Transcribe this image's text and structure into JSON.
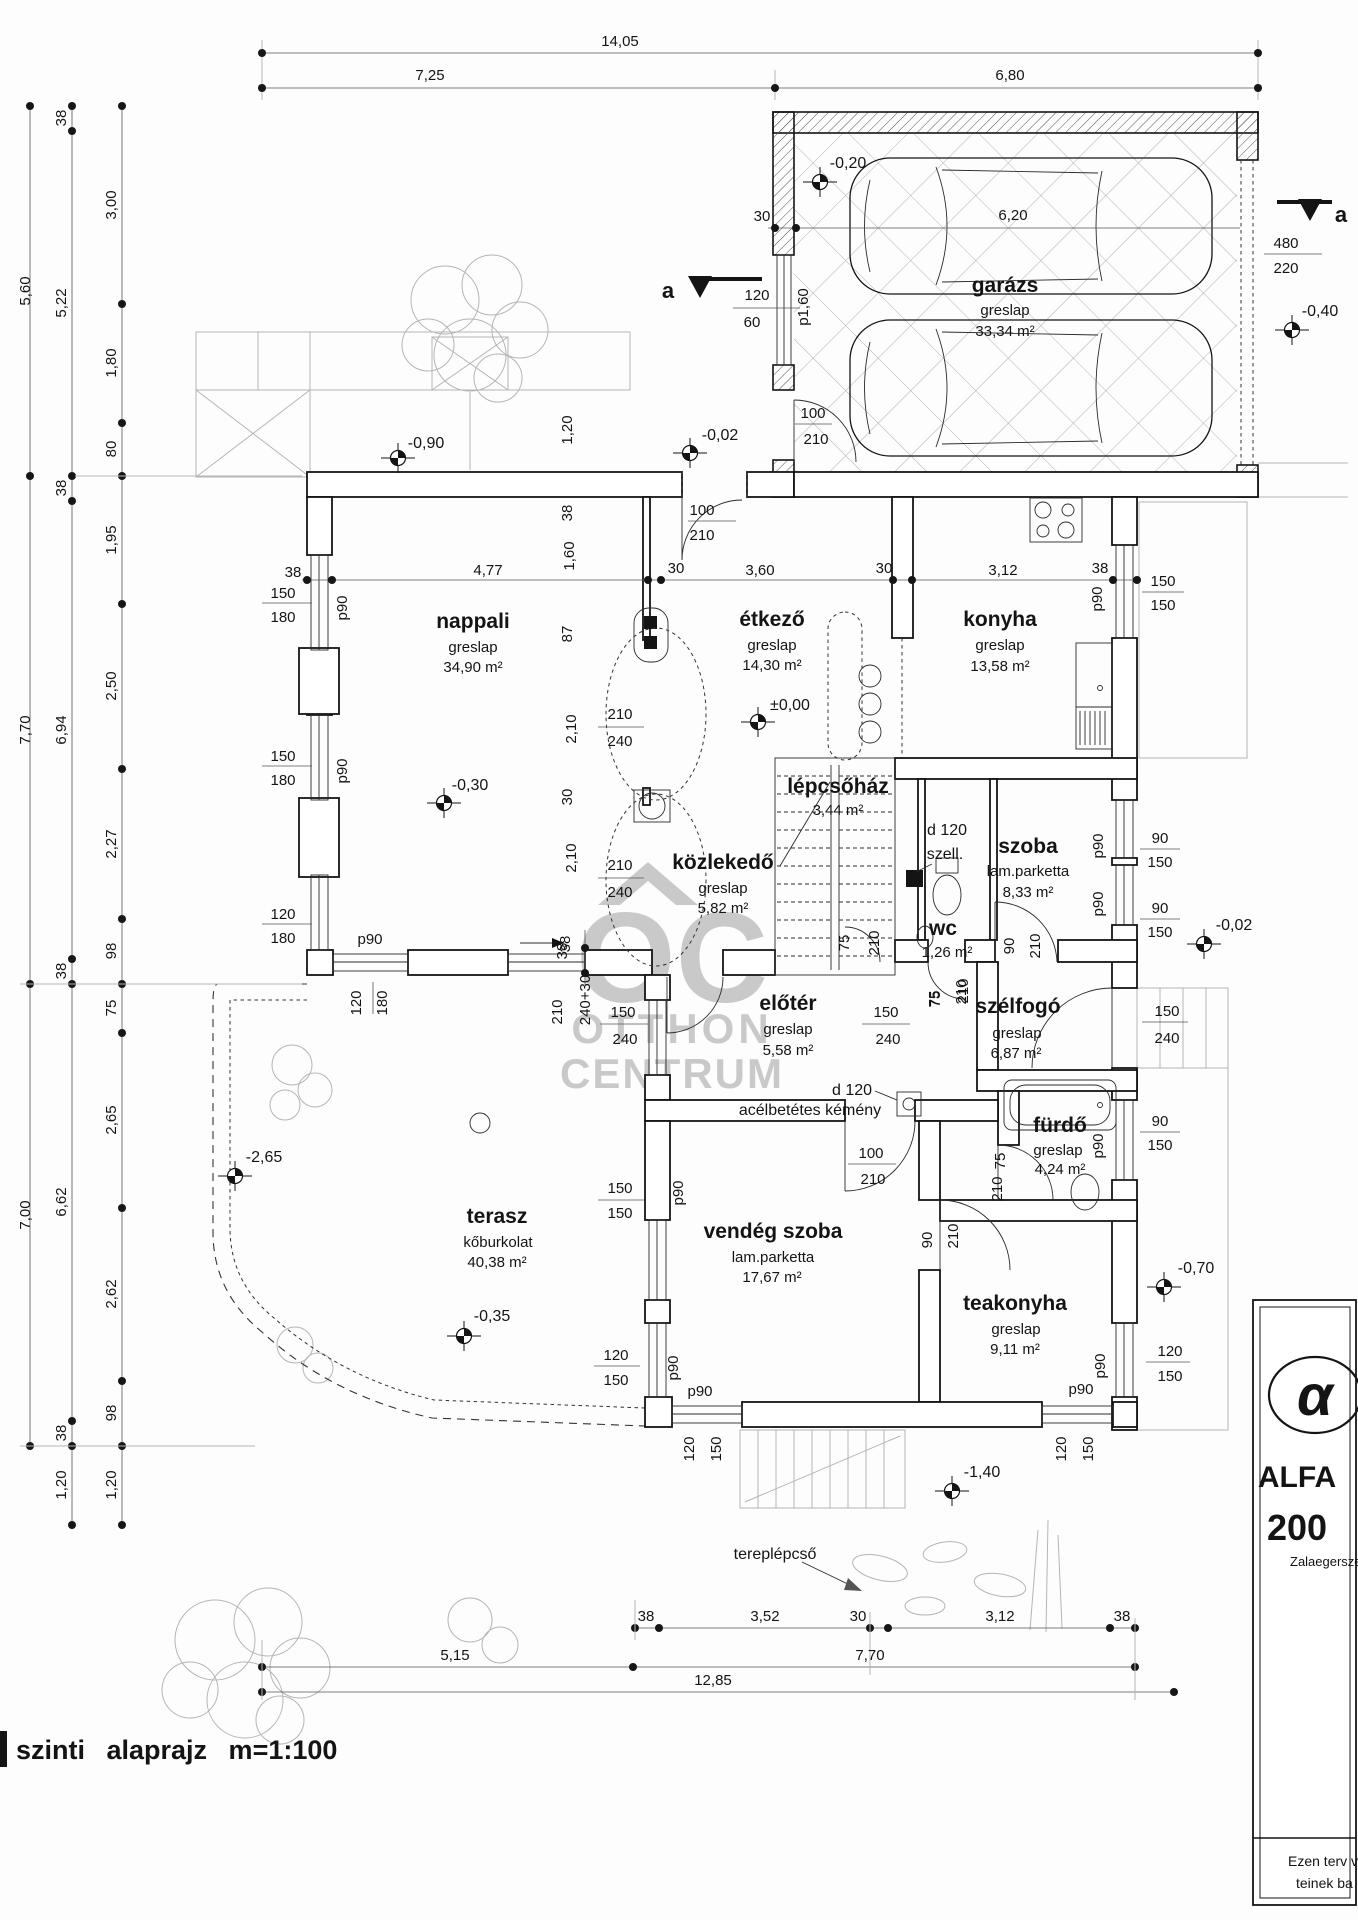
{
  "page": {
    "title": "szinti alaprajz m=1:100"
  },
  "watermark": {
    "l0": "OC",
    "l1": "OTTHON",
    "l2": "CENTRUM"
  },
  "title_block": {
    "glyph": "α",
    "l1": "ALFA",
    "l2": "200",
    "l3": "Zalaegersze",
    "n1": "Ezen terv v",
    "n2": "teinek ba"
  },
  "rooms": {
    "garazs": {
      "name": "garázs",
      "floor": "greslap",
      "area": "33,34 m²"
    },
    "nappali": {
      "name": "nappali",
      "floor": "greslap",
      "area": "34,90 m²"
    },
    "etkezo": {
      "name": "étkező",
      "floor": "greslap",
      "area": "14,30 m²"
    },
    "konyha": {
      "name": "konyha",
      "floor": "greslap",
      "area": "13,58 m²"
    },
    "lepcsohaz": {
      "name": "lépcsőház",
      "area": "3,44 m²"
    },
    "kozlekedo": {
      "name": "közlekedő",
      "floor": "greslap",
      "area": "5,82 m²"
    },
    "szoba": {
      "name": "szoba",
      "floor": "lam.parketta",
      "area": "8,33 m²"
    },
    "wc": {
      "name": "wc",
      "area": "1,26 m²"
    },
    "eloter": {
      "name": "előtér",
      "floor": "greslap",
      "area": "5,58 m²"
    },
    "szelfogo": {
      "name": "szélfogó",
      "floor": "greslap",
      "area": "6,87 m²"
    },
    "furdo": {
      "name": "fürdő",
      "floor": "greslap",
      "area": "4,24 m²"
    },
    "vendeg": {
      "name": "vendég szoba",
      "floor": "lam.parketta",
      "area": "17,67 m²"
    },
    "teakonyha": {
      "name": "teakonyha",
      "floor": "greslap",
      "area": "9,11 m²"
    },
    "terasz": {
      "name": "terasz",
      "floor": "kőburkolat",
      "area": "40,38 m²"
    }
  },
  "levels": {
    "g": "-0,20",
    "ne": "-0,40",
    "nw": "-0,90",
    "nd": "-0,02",
    "zero": "±0,00",
    "nap": "-0,30",
    "e": "-0,02",
    "t1": "-2,65",
    "t2": "-0,35",
    "se": "-0,70",
    "s": "-1,40"
  },
  "d": {
    "top": [
      "14,05",
      "7,25",
      "6,80"
    ],
    "la": [
      "5,60",
      "7,70",
      "7,00"
    ],
    "lb": [
      "38",
      "5,22",
      "38",
      "6,94",
      "38",
      "6,62",
      "38",
      "1,20"
    ],
    "lc": [
      "3,00",
      "1,80",
      "80",
      "1,95",
      "2,50",
      "2,27",
      "98",
      "75",
      "2,65",
      "2,62",
      "98",
      "1,20"
    ],
    "b1": [
      "38",
      "3,52",
      "30",
      "3,12",
      "38"
    ],
    "b2": [
      "5,15",
      "7,70"
    ],
    "b3": [
      "12,85"
    ],
    "mid": [
      "1,20",
      "38",
      "1,60",
      "87",
      "2,10",
      "30",
      "2,10",
      "38"
    ],
    "gar": [
      "30",
      "6,20",
      "120",
      "60",
      "p1,60",
      "100",
      "210",
      "480",
      "220"
    ],
    "north_door": [
      "100",
      "210"
    ],
    "nap": [
      "38",
      "4,77",
      "150",
      "180",
      "p90",
      "150",
      "180",
      "p90",
      "120",
      "180"
    ],
    "etk": [
      "30",
      "3,60",
      "30"
    ],
    "kon": [
      "3,12",
      "38",
      "p90",
      "150",
      "150"
    ],
    "szo": [
      "p90",
      "90",
      "150",
      "p90",
      "90",
      "150",
      "90",
      "210"
    ],
    "wc": [
      "75",
      "210"
    ],
    "lep": [
      "75",
      "210"
    ],
    "koz": [
      "210",
      "240",
      "210",
      "240"
    ],
    "elo": [
      "150",
      "240",
      "150",
      "240",
      "75",
      "210"
    ],
    "bej": [
      "150",
      "240"
    ],
    "fur": [
      "75",
      "210",
      "p90",
      "90",
      "150"
    ],
    "ven": [
      "150",
      "150",
      "p90",
      "120",
      "150",
      "p90",
      "p90",
      "120",
      "150",
      "100",
      "210",
      "90",
      "210"
    ],
    "tea": [
      "p90",
      "120",
      "150",
      "p90",
      "120",
      "150"
    ],
    "ter": [
      "38",
      "210",
      "240+30",
      "p90",
      "120",
      "180"
    ],
    "sec": [
      "a",
      "a"
    ],
    "misc": [
      "tereplépcső",
      "d 120",
      "szell.",
      "d 120",
      "acélbetétes kémény"
    ]
  }
}
